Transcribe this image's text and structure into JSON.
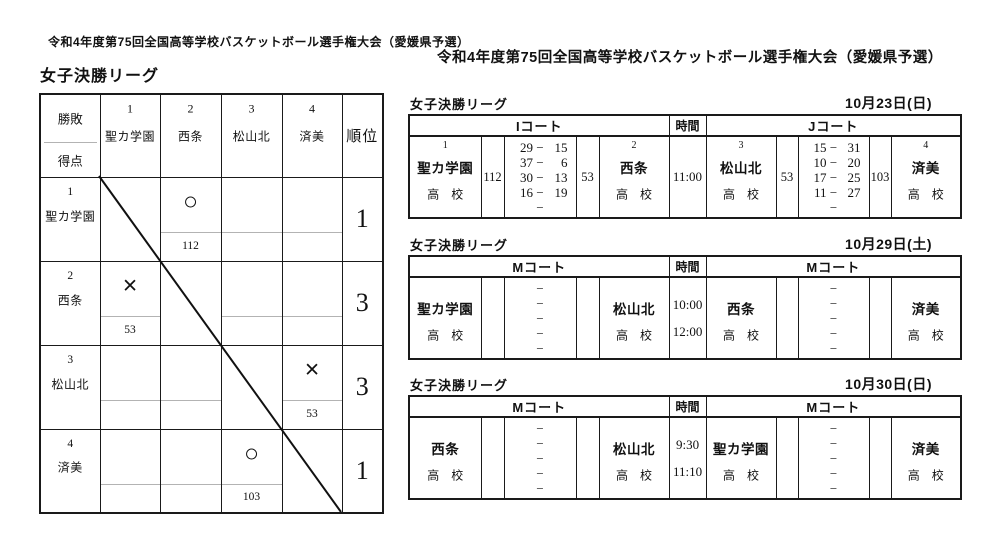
{
  "ui": {
    "dash": "−"
  },
  "titles": {
    "tournament_left": "令和4年度第75回全国高等学校バスケットボール選手権大会（愛媛県予選）",
    "tournament_right": "令和4年度第75回全国高等学校バスケットボール選手権大会（愛媛県予選）",
    "league_left": "女子決勝リーグ"
  },
  "matrix": {
    "header": {
      "win_loss": "勝敗",
      "points": "得点",
      "rank": "順位"
    },
    "col_teams": [
      {
        "seed": "1",
        "name": "聖カ学園"
      },
      {
        "seed": "2",
        "name": "西条"
      },
      {
        "seed": "3",
        "name": "松山北"
      },
      {
        "seed": "4",
        "name": "済美"
      }
    ],
    "rows": [
      {
        "seed": "1",
        "name": "聖カ学園",
        "rank": "1",
        "cells": [
          {
            "self": true,
            "sym": "",
            "score": ""
          },
          {
            "sym": "○",
            "score": "112"
          },
          {
            "sym": "",
            "score": ""
          },
          {
            "sym": "",
            "score": ""
          }
        ]
      },
      {
        "seed": "2",
        "name": "西条",
        "rank": "3",
        "cells": [
          {
            "sym": "×",
            "score": "53"
          },
          {
            "self": true,
            "sym": "",
            "score": ""
          },
          {
            "sym": "",
            "score": ""
          },
          {
            "sym": "",
            "score": ""
          }
        ]
      },
      {
        "seed": "3",
        "name": "松山北",
        "rank": "3",
        "cells": [
          {
            "sym": "",
            "score": ""
          },
          {
            "sym": "",
            "score": ""
          },
          {
            "self": true,
            "sym": "",
            "score": ""
          },
          {
            "sym": "×",
            "score": "53"
          }
        ]
      },
      {
        "seed": "4",
        "name": "済美",
        "rank": "1",
        "cells": [
          {
            "sym": "",
            "score": ""
          },
          {
            "sym": "",
            "score": ""
          },
          {
            "sym": "○",
            "score": "103"
          },
          {
            "self": true,
            "sym": "",
            "score": ""
          }
        ]
      }
    ]
  },
  "schedules": [
    {
      "league_label": "女子決勝リーグ",
      "date": "10月23日(日)",
      "time_label": "時間",
      "courts": {
        "left": "Iコート",
        "right": "Jコート"
      },
      "times": [
        "11:00"
      ],
      "left_game": {
        "home": {
          "seed": "1",
          "name": "聖カ学園",
          "suffix": "高　校"
        },
        "home_total": "112",
        "quarters": [
          {
            "h": "29",
            "a": "15"
          },
          {
            "h": "37",
            "a": "6"
          },
          {
            "h": "30",
            "a": "13"
          },
          {
            "h": "16",
            "a": "19"
          },
          {
            "h": "",
            "a": ""
          }
        ],
        "away_total": "53",
        "away": {
          "seed": "2",
          "name": "西条",
          "suffix": "高　校"
        }
      },
      "right_game": {
        "home": {
          "seed": "3",
          "name": "松山北",
          "suffix": "高　校"
        },
        "home_total": "53",
        "quarters": [
          {
            "h": "15",
            "a": "31"
          },
          {
            "h": "10",
            "a": "20"
          },
          {
            "h": "17",
            "a": "25"
          },
          {
            "h": "11",
            "a": "27"
          },
          {
            "h": "",
            "a": ""
          }
        ],
        "away_total": "103",
        "away": {
          "seed": "4",
          "name": "済美",
          "suffix": "高　校"
        }
      }
    },
    {
      "league_label": "女子決勝リーグ",
      "date": "10月29日(土)",
      "time_label": "時間",
      "courts": {
        "left": "Mコート",
        "right": "Mコート"
      },
      "times": [
        "10:00",
        "12:00"
      ],
      "left_game": {
        "home": {
          "seed": "",
          "name": "聖カ学園",
          "suffix": "高　校"
        },
        "home_total": "",
        "quarters": [
          {
            "h": "",
            "a": ""
          },
          {
            "h": "",
            "a": ""
          },
          {
            "h": "",
            "a": ""
          },
          {
            "h": "",
            "a": ""
          },
          {
            "h": "",
            "a": ""
          }
        ],
        "away_total": "",
        "away": {
          "seed": "",
          "name": "松山北",
          "suffix": "高　校"
        }
      },
      "right_game": {
        "home": {
          "seed": "",
          "name": "西条",
          "suffix": "高　校"
        },
        "home_total": "",
        "quarters": [
          {
            "h": "",
            "a": ""
          },
          {
            "h": "",
            "a": ""
          },
          {
            "h": "",
            "a": ""
          },
          {
            "h": "",
            "a": ""
          },
          {
            "h": "",
            "a": ""
          }
        ],
        "away_total": "",
        "away": {
          "seed": "",
          "name": "済美",
          "suffix": "高　校"
        }
      }
    },
    {
      "league_label": "女子決勝リーグ",
      "date": "10月30日(日)",
      "time_label": "時間",
      "courts": {
        "left": "Mコート",
        "right": "Mコート"
      },
      "times": [
        "9:30",
        "11:10"
      ],
      "left_game": {
        "home": {
          "seed": "",
          "name": "西条",
          "suffix": "高　校"
        },
        "home_total": "",
        "quarters": [
          {
            "h": "",
            "a": ""
          },
          {
            "h": "",
            "a": ""
          },
          {
            "h": "",
            "a": ""
          },
          {
            "h": "",
            "a": ""
          },
          {
            "h": "",
            "a": ""
          }
        ],
        "away_total": "",
        "away": {
          "seed": "",
          "name": "松山北",
          "suffix": "高　校"
        }
      },
      "right_game": {
        "home": {
          "seed": "",
          "name": "聖カ学園",
          "suffix": "高　校"
        },
        "home_total": "",
        "quarters": [
          {
            "h": "",
            "a": ""
          },
          {
            "h": "",
            "a": ""
          },
          {
            "h": "",
            "a": ""
          },
          {
            "h": "",
            "a": ""
          },
          {
            "h": "",
            "a": ""
          }
        ],
        "away_total": "",
        "away": {
          "seed": "",
          "name": "済美",
          "suffix": "高　校"
        }
      }
    }
  ]
}
